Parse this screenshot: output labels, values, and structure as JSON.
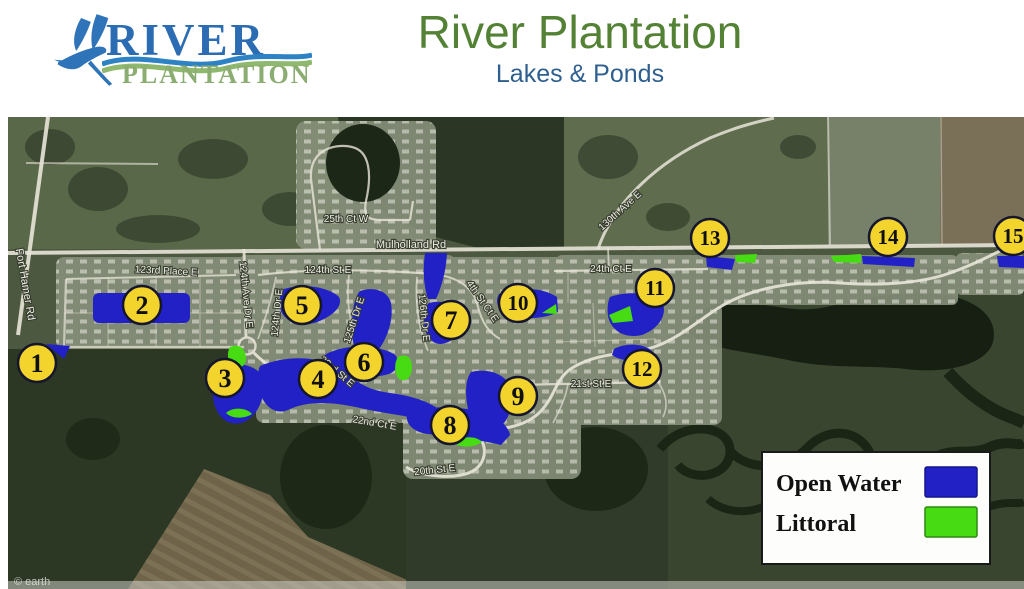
{
  "header": {
    "logo": {
      "top_text": "RIVER",
      "bottom_text": "PLANTATION"
    },
    "title": "River Plantation",
    "subtitle": "Lakes & Ponds"
  },
  "map": {
    "markers": [
      "1",
      "2",
      "3",
      "4",
      "5",
      "6",
      "7",
      "8",
      "9",
      "10",
      "11",
      "12",
      "13",
      "14",
      "15"
    ],
    "streets": [
      "Fort Hamer Rd",
      "123rd Place E",
      "124th Ave Dr E",
      "25th Ct W",
      "Mulholland Rd",
      "124th St E",
      "124th Dr E",
      "125th Dr E",
      "126th Dr E",
      "4th St Ct E",
      "23rd St E",
      "22nd Ct E",
      "20th St E",
      "21st St E",
      "24th Ct E",
      "130th Ave E"
    ],
    "watermark": "© earth",
    "legend": {
      "items": [
        {
          "label": "Open Water",
          "color": "#2121C6"
        },
        {
          "label": "Littoral",
          "color": "#46DB12"
        }
      ]
    }
  },
  "colors": {
    "open_water": "#2121C6",
    "littoral": "#46DB12",
    "marker_fill": "#F3D42C",
    "title_green": "#548235",
    "subtitle_blue": "#2E5F8F",
    "logo_blue": "#2B6CB3",
    "logo_green": "#8CAD71"
  }
}
